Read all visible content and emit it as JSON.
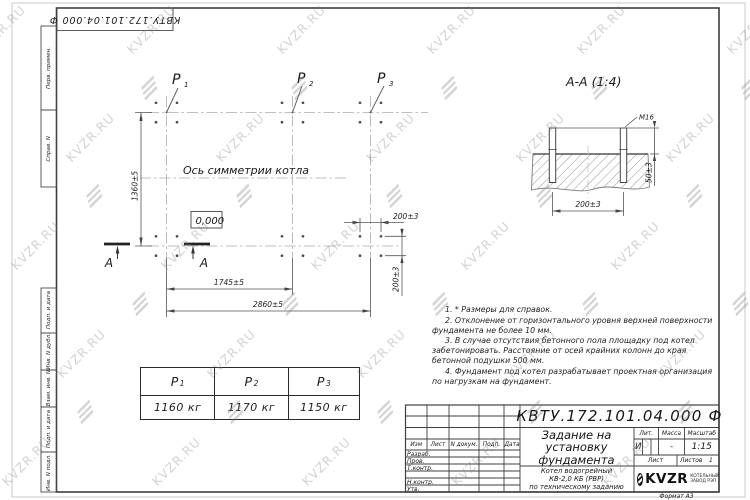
{
  "watermark": {
    "text": "KVZR.RU"
  },
  "corner_stamp": {
    "doc_number": "КВТУ.172.101.04.000  Ф"
  },
  "margin_labels": [
    "Перв. примен.",
    "Справ. N",
    "Подп. и дата",
    "Инв. N дубл.",
    "Взам. инв. N",
    "Подп. и дата",
    "Инв. N подл."
  ],
  "plan": {
    "points": [
      {
        "p": "P",
        "sub": "1"
      },
      {
        "p": "P",
        "sub": "2"
      },
      {
        "p": "P",
        "sub": "3"
      }
    ],
    "axis_label": "Ось симметрии котла",
    "elevation_mark": "0,000",
    "section_letter": "А",
    "dim_height": "1360±5",
    "dim_span_p1_p2": "1745±5",
    "dim_span_total": "2860±5",
    "dim_bolt_spacing_x": "200±3",
    "dim_bolt_spacing_y": "200±3"
  },
  "section_view": {
    "title": "А-А (1:4)",
    "thread_label": "М16",
    "dim_bolt_spacing": "200±3",
    "dim_protrusion": "50±3"
  },
  "notes": [
    "1. * Размеры для справок.",
    "2. Отклонение от горизонтального уровня верхней поверхности фундамента не более 10 мм.",
    "3. В случае отсутствия бетонного пола площадку под котел забетонировать. Расстояние от осей крайних колонн до края бетонной подушки 500 мм.",
    "4. Фундамент под котел разрабатывает проектная организация по нагрузкам на фундамент."
  ],
  "load_table": {
    "headers": [
      {
        "p": "P",
        "sub": "1"
      },
      {
        "p": "P",
        "sub": "2"
      },
      {
        "p": "P",
        "sub": "3"
      }
    ],
    "values": [
      "1160 кг",
      "1170 кг",
      "1150 кг"
    ]
  },
  "title_block": {
    "doc_number": "КВТУ.172.101.04.000  Ф",
    "rev_header": [
      "Изм",
      "Лист",
      "N докум.",
      "Подп.",
      "Дата"
    ],
    "row_labels": [
      "Разраб.",
      "Пров.",
      "Т.контр.",
      "",
      "Н.контр.",
      "Утв."
    ],
    "title_lines": [
      "Задание на",
      "установку",
      "фундамента"
    ],
    "product_lines": [
      "Котел водогрейный",
      "КВ-2,0 КБ (РВР)",
      "по техническому заданию"
    ],
    "lit_header": "Лит.",
    "mass_header": "Масса",
    "scale_header": "Масштаб",
    "lit_value": "И",
    "mass_value": "-",
    "scale_value": "1:15",
    "sheet_label": "Лист",
    "sheets_label": "Листов",
    "sheets_value": "1",
    "company": {
      "logo_text": "KVZR",
      "line1": "КОТЕЛЬНЫЙ",
      "line2": "ЗАВОД РЭП"
    },
    "format_label": "Формат А3"
  }
}
